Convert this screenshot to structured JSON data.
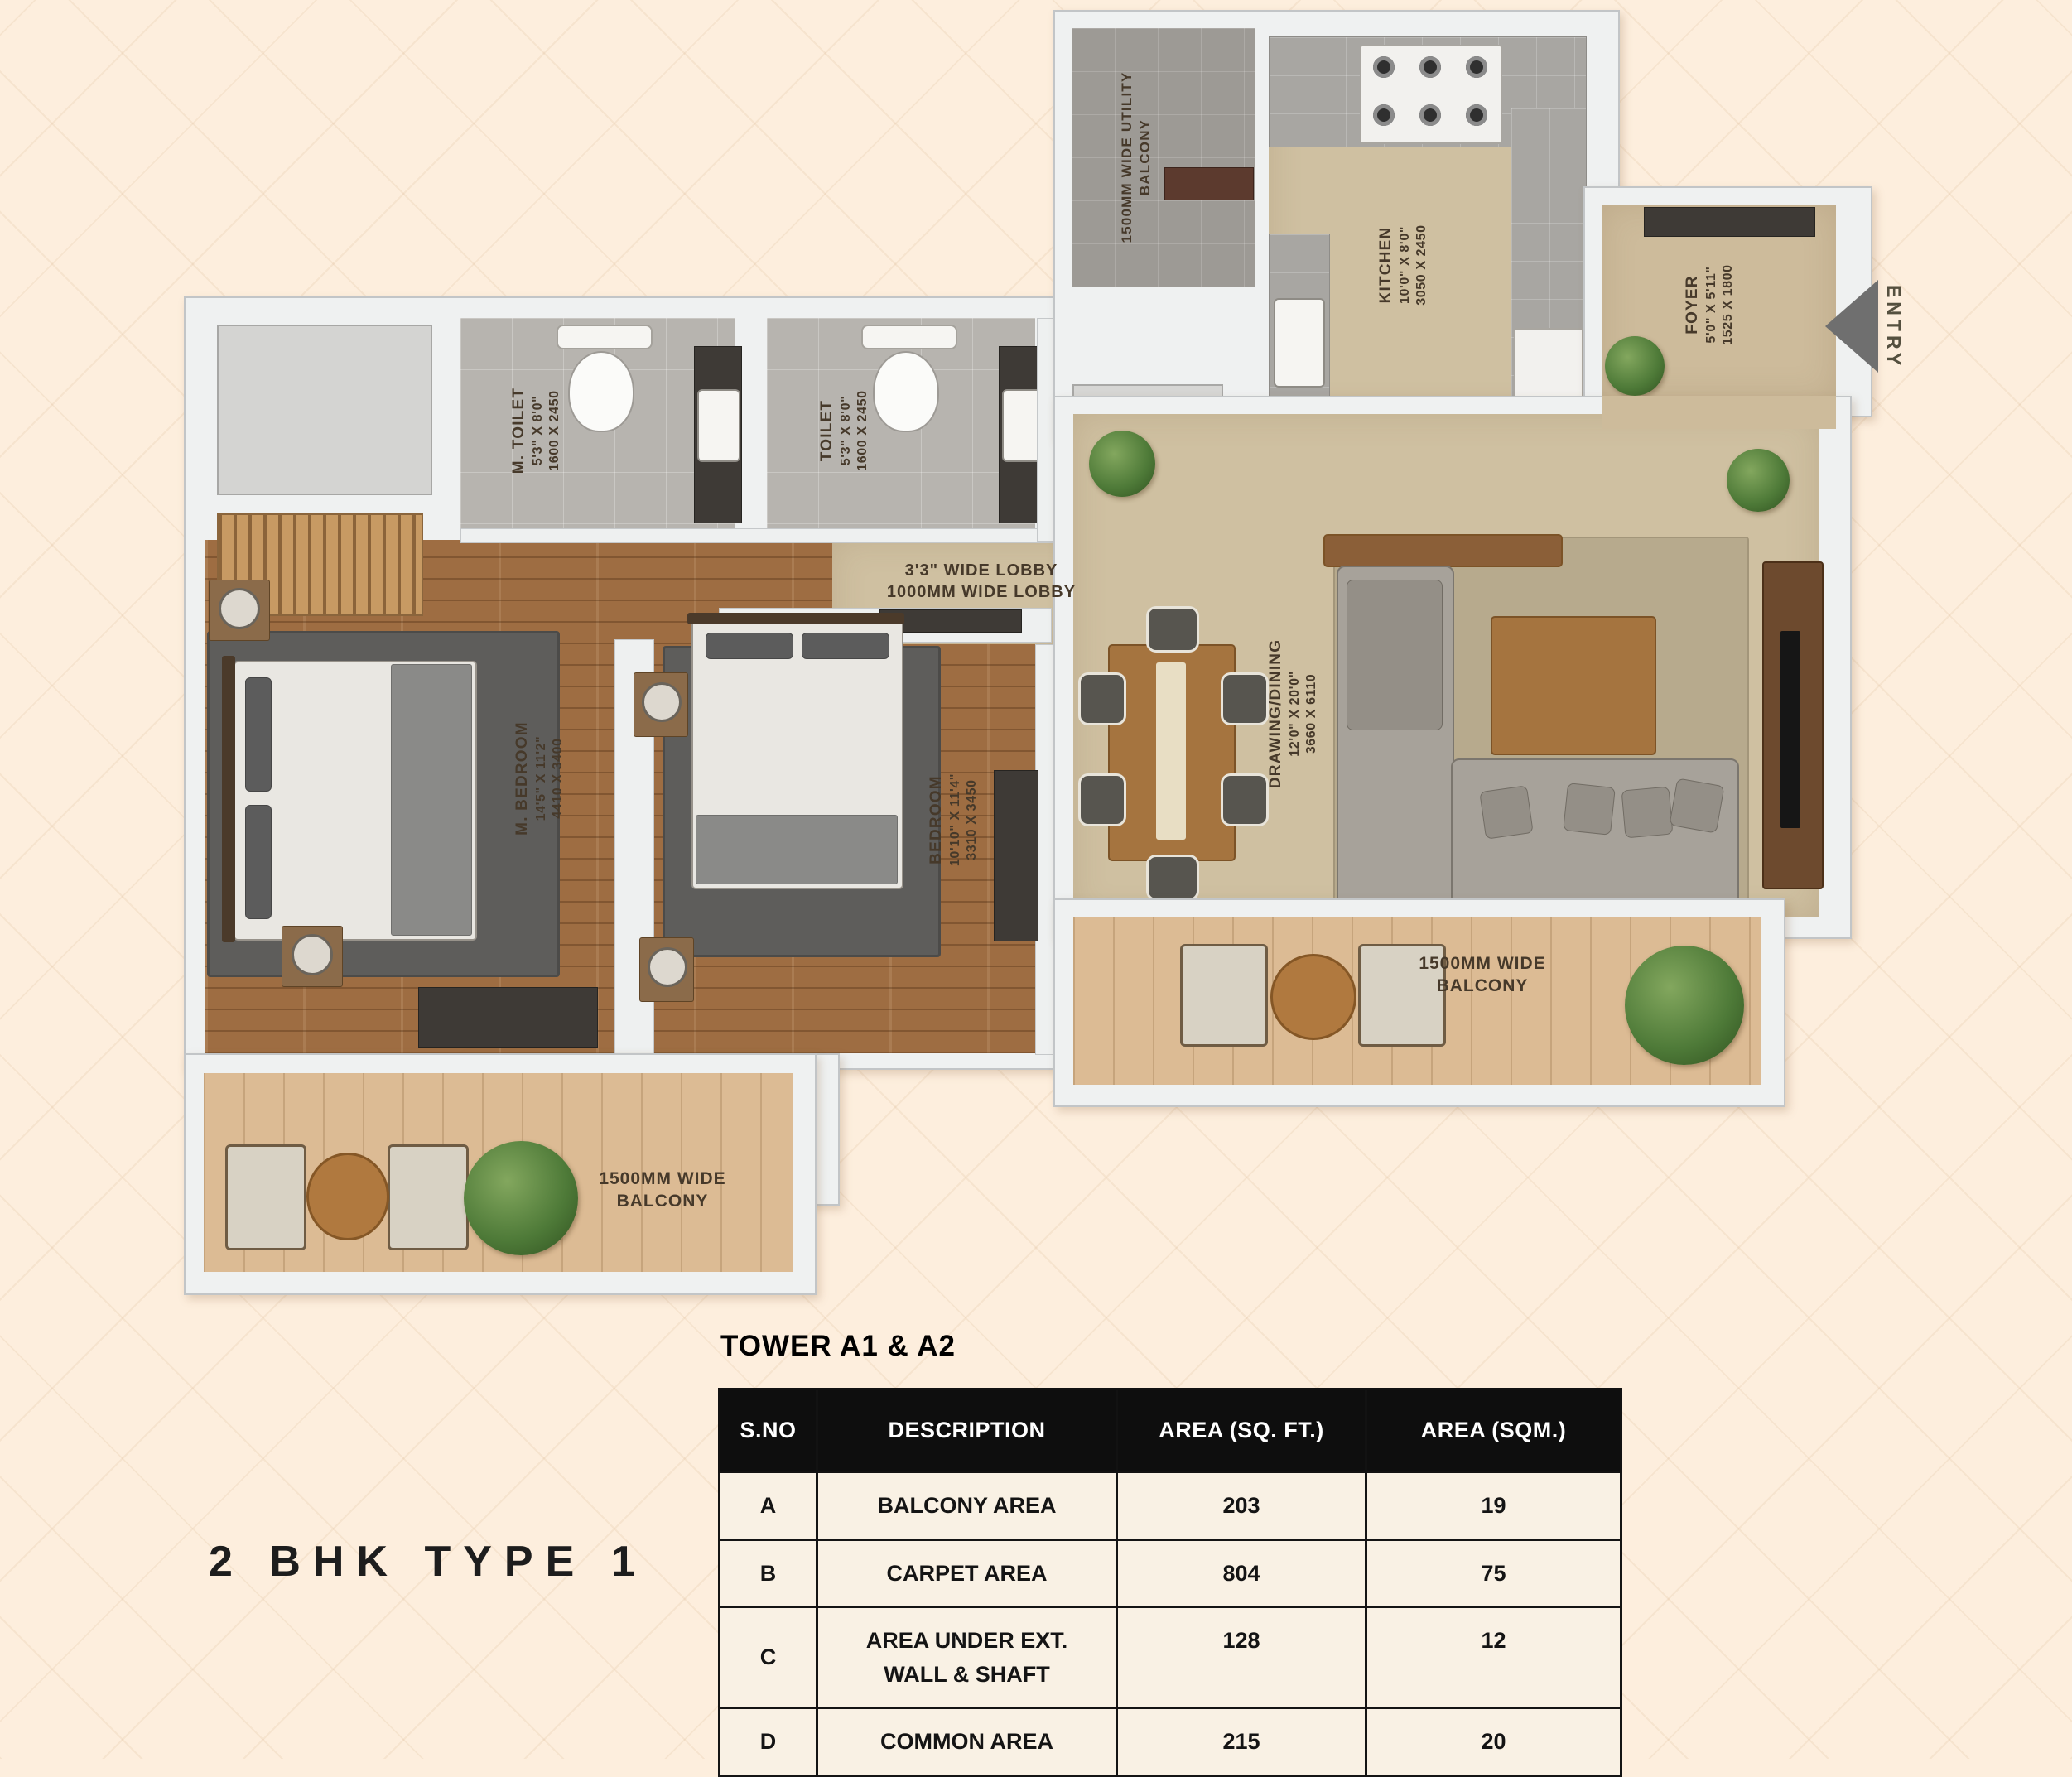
{
  "title": "2 BHK TYPE 1",
  "plan": {
    "entry": "ENTRY",
    "lobby": {
      "line1": "3'3\" WIDE LOBBY",
      "line2": "1000MM WIDE LOBBY"
    },
    "rooms": {
      "m_toilet": {
        "name": "M. TOILET",
        "ft": "5'3\" X 8'0\"",
        "mm": "1600 X 2450"
      },
      "toilet": {
        "name": "TOILET",
        "ft": "5'3\" X 8'0\"",
        "mm": "1600 X 2450"
      },
      "kitchen": {
        "name": "KITCHEN",
        "ft": "10'0\" X 8'0\"",
        "mm": "3050 X 2450"
      },
      "foyer": {
        "name": "FOYER",
        "ft": "5'0\" X 5'11\"",
        "mm": "1525 X 1800"
      },
      "m_bedroom": {
        "name": "M. BEDROOM",
        "ft": "14'5\" X 11'2\"",
        "mm": "4410 X 3400"
      },
      "bedroom": {
        "name": "BEDROOM",
        "ft": "10'10\" X 11'4\"",
        "mm": "3310 X 3450"
      },
      "drawing": {
        "name": "DRAWING/DINING",
        "ft": "12'0\" X 20'0\"",
        "mm": "3660 X 6110"
      },
      "utility_balcony": {
        "line1": "1500MM WIDE UTILITY",
        "line2": "BALCONY"
      },
      "balcony_left": {
        "line1": "1500MM WIDE",
        "line2": "BALCONY"
      },
      "balcony_right": {
        "line1": "1500MM WIDE",
        "line2": "BALCONY"
      }
    }
  },
  "table": {
    "caption": "TOWER A1 & A2",
    "headers": [
      "S.NO",
      "DESCRIPTION",
      "AREA (SQ. FT.)",
      "AREA (SQM.)"
    ],
    "rows": [
      [
        "A",
        "BALCONY AREA",
        "203",
        "19"
      ],
      [
        "B",
        "CARPET AREA",
        "804",
        "75"
      ],
      [
        "C",
        "AREA UNDER EXT. WALL & SHAFT",
        "128",
        "12"
      ],
      [
        "D",
        "COMMON AREA",
        "215",
        "20"
      ]
    ]
  },
  "colors": {
    "background": "#fdeedd",
    "wall": "#eff1f1",
    "wood_floor": "#9e6d42",
    "balcony_floor": "#dcbb94",
    "tile_floor": "#b7b4af",
    "utility_floor": "#9d9a95",
    "beige_floor": "#cfc0a1",
    "label_text": "#46392a",
    "entry_arrow": "#6f6f6f",
    "table_header_bg": "#0e0e0e",
    "table_row_bg": "#f9f1e4"
  }
}
